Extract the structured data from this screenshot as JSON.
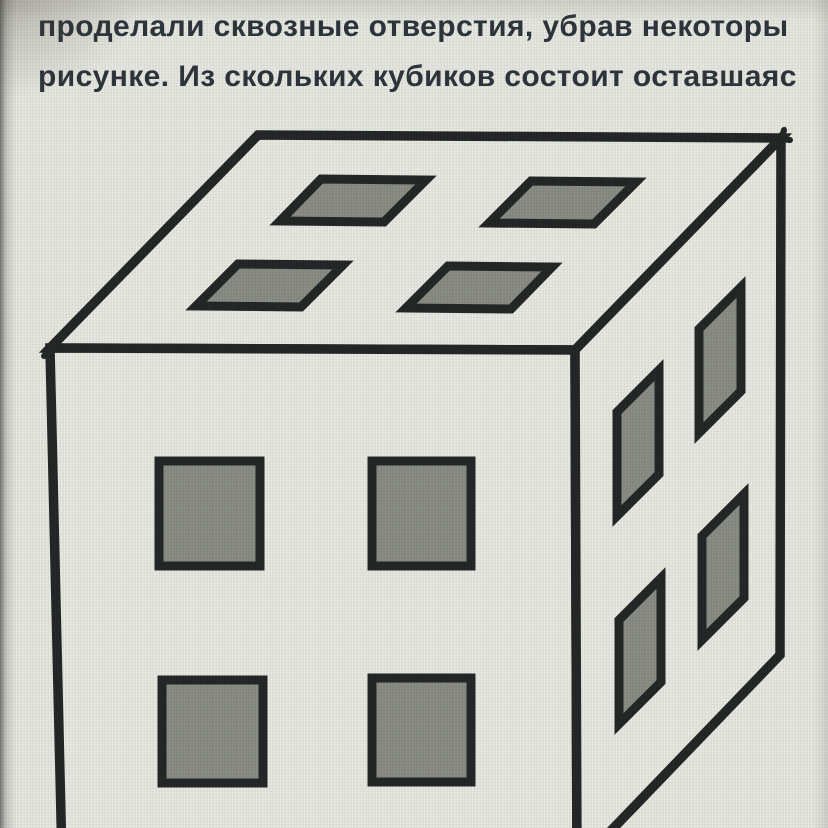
{
  "problem_text": {
    "line1": "проделали сквозные отверстия, убрав некоторы",
    "line2": "рисунке. Из скольких кубиков состоит оставшаяс"
  },
  "figure": {
    "name": "cube-with-through-holes",
    "description": "Cube built of small cubes; 2x2 pattern of square through-holes on the top, front and right faces",
    "visible_faces": [
      "top",
      "front",
      "right"
    ],
    "holes_per_face": 4,
    "hole_grid": "2x2",
    "hole_span_fractions": [
      [
        0.2,
        0.4
      ],
      [
        0.6,
        0.8
      ]
    ]
  },
  "colors": {
    "background": "#e7e8e1",
    "face": "#e8e9e2",
    "hole_fill": "#858780",
    "line": "#191b1c",
    "text": "#232a33"
  }
}
